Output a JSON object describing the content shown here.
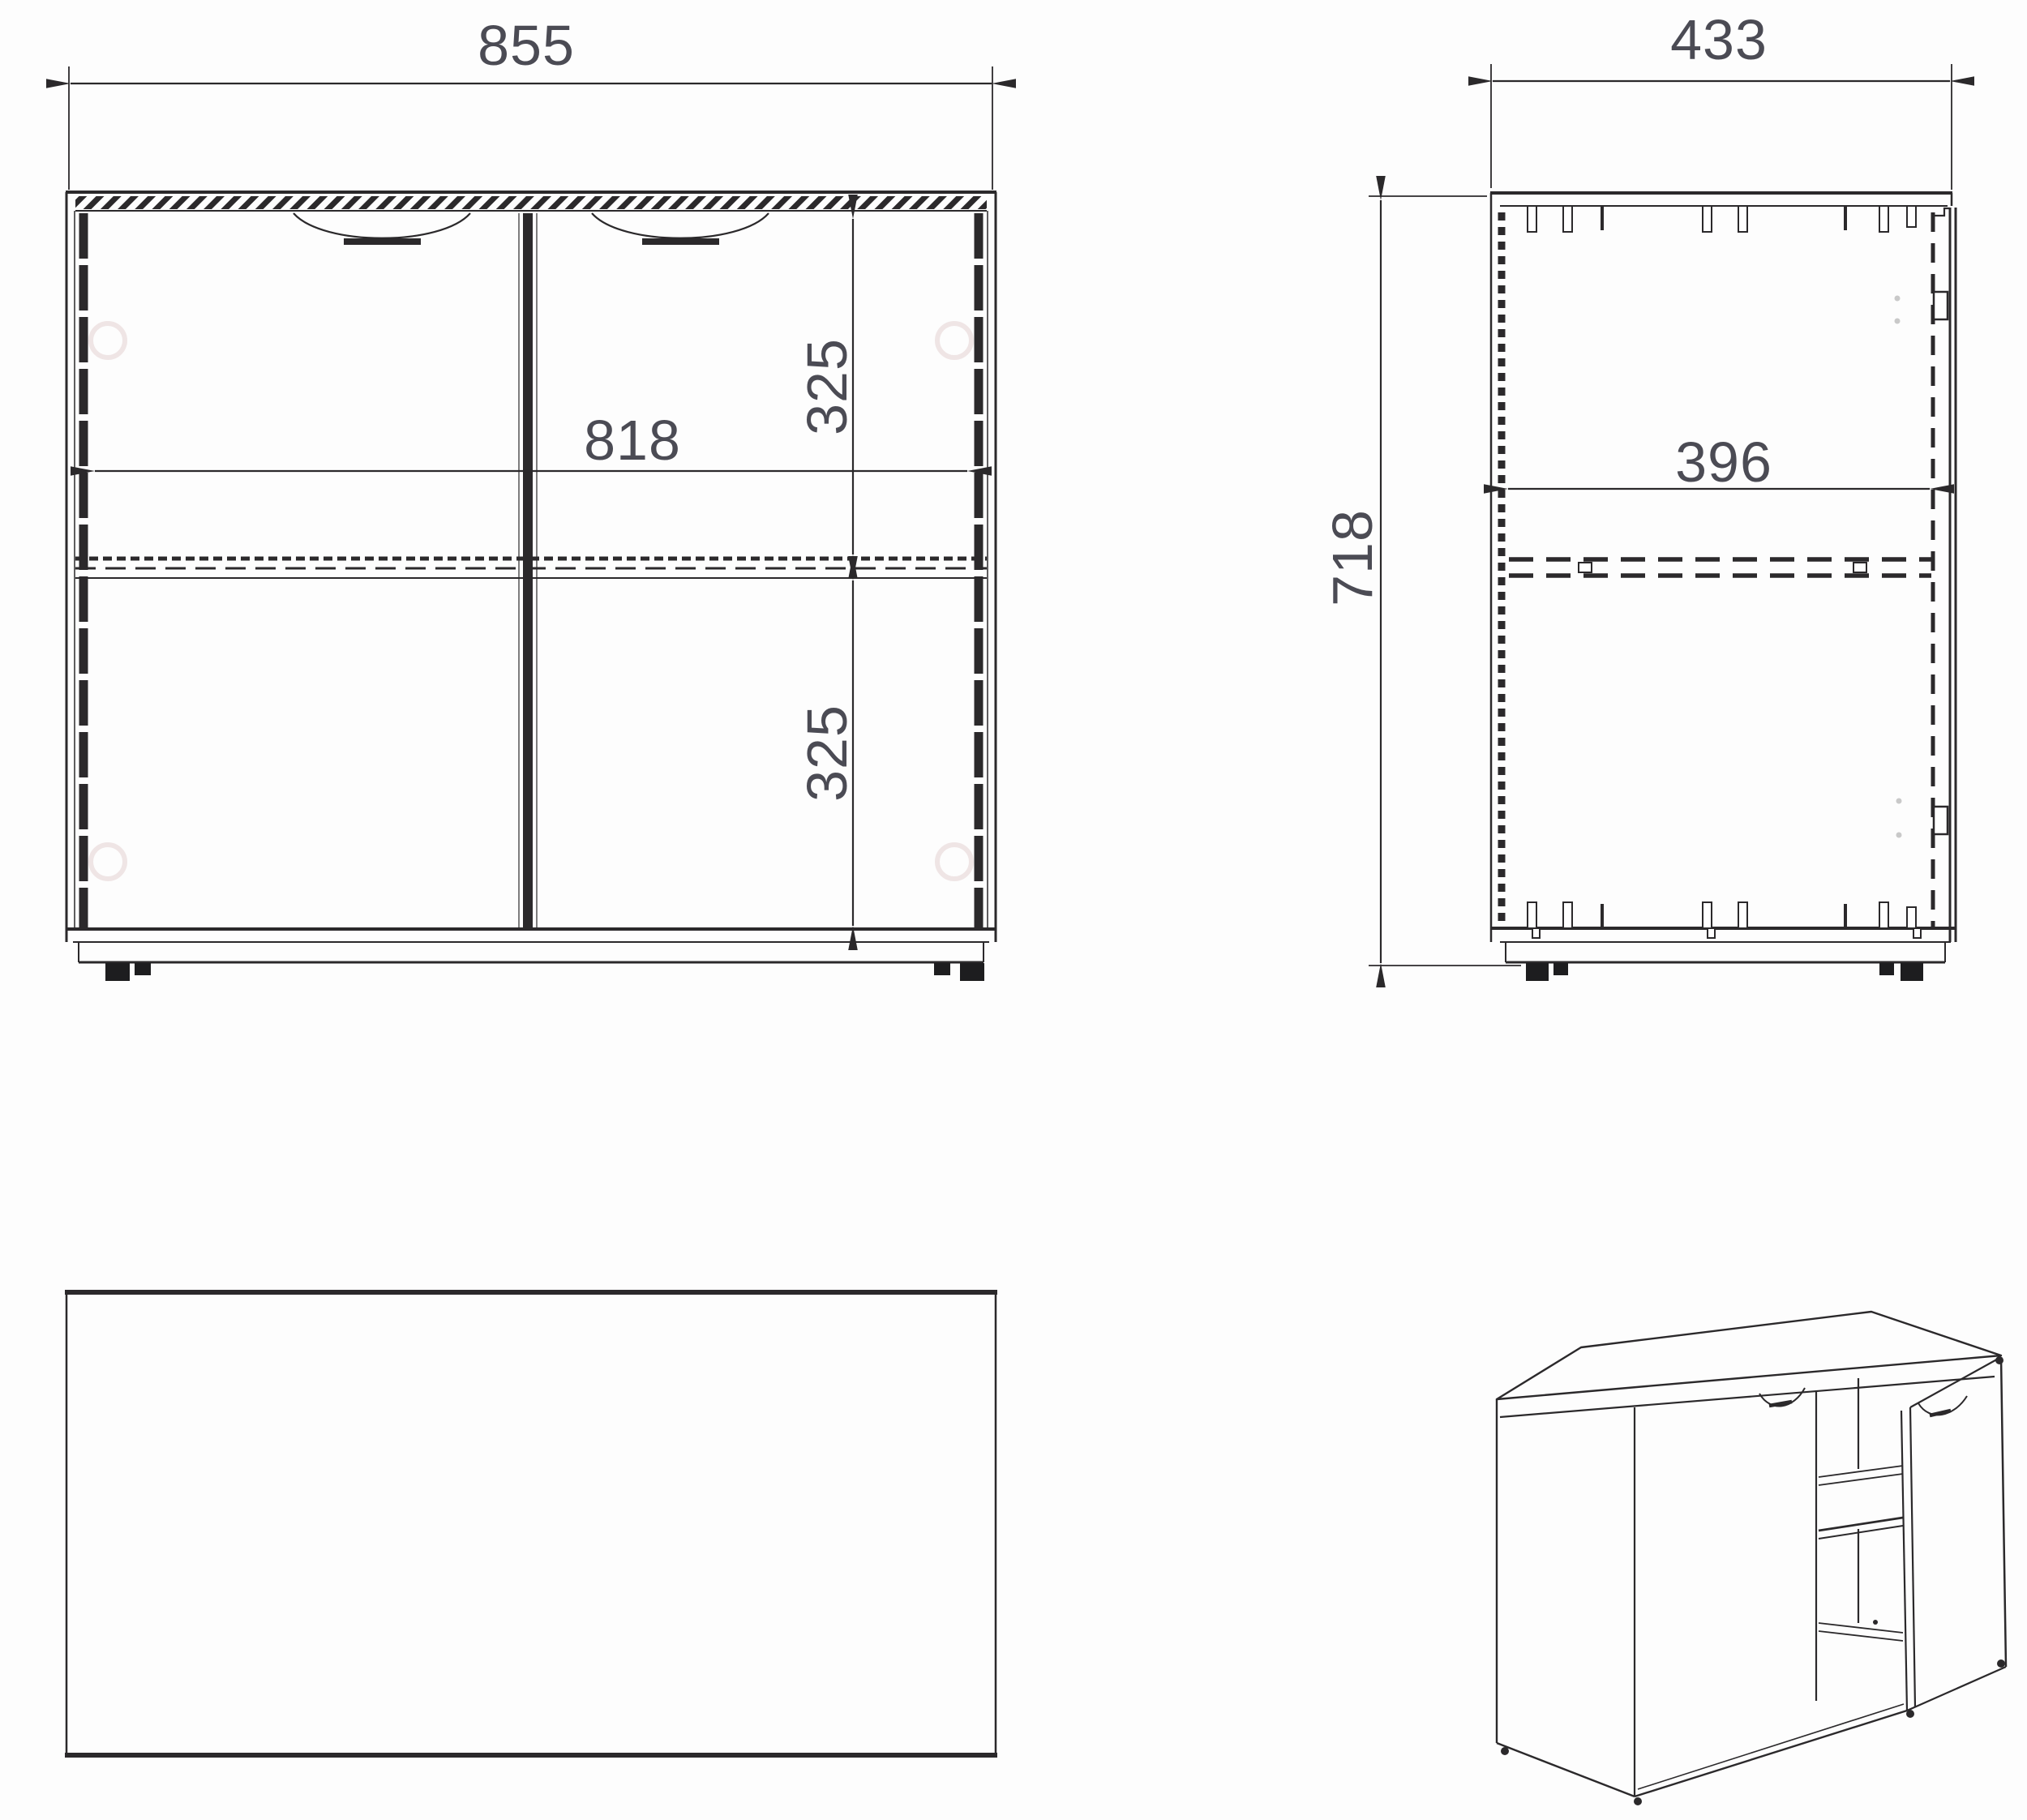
{
  "meta": {
    "title": "Two-door cabinet technical drawing"
  },
  "colors": {
    "line": "#2b292b",
    "dim-text": "#4b4b54",
    "faint": "#e6d6d6",
    "foot": "#1d1d1f",
    "background": "#fdfdfd",
    "hinge-dot": "#c9c9c9"
  },
  "views": {
    "front": {
      "label": "front-view",
      "width": "855",
      "inner_width": "818",
      "upper_section_height": "325",
      "lower_section_height": "325"
    },
    "side": {
      "label": "side-view",
      "depth": "433",
      "height": "718",
      "inner_depth": "396"
    },
    "top": {
      "label": "top-view"
    },
    "iso": {
      "label": "iso-view"
    }
  }
}
